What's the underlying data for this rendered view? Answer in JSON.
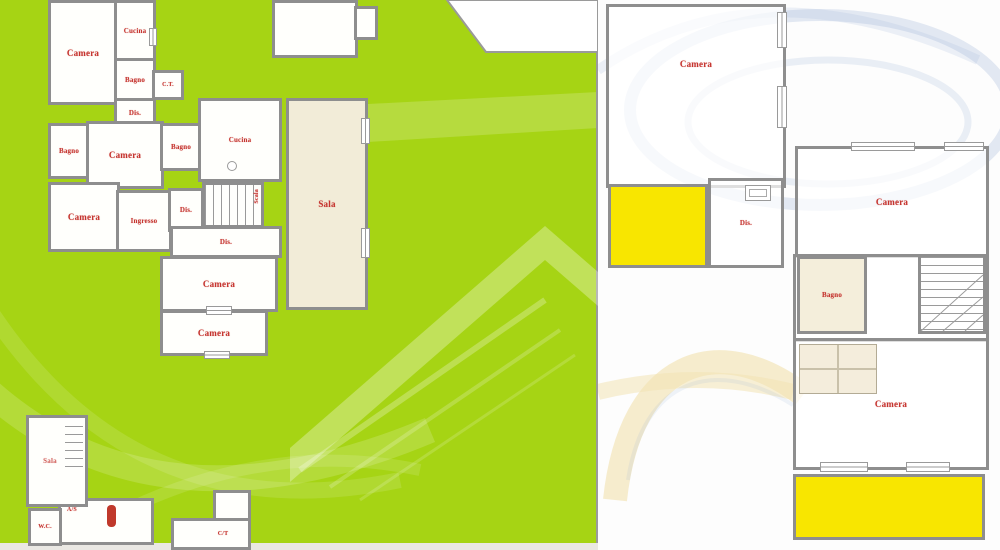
{
  "doc": {
    "type": "real-estate floor plan listing image",
    "floors": 2
  },
  "colors": {
    "ground_bg_green": "#a6d414",
    "highlight_yellow": "#f8e600",
    "room_cream": "#f2ecd8",
    "wall_gray": "#8e8e8e",
    "label_red": "#c5342f",
    "watermark_blue": "#9db4d6"
  },
  "plans": {
    "ground": {
      "name": "Ground floor plan",
      "rooms": {
        "camera_nw": "Camera",
        "cucina_nw": "Cucina",
        "bagno_nw": "Bagno",
        "ct": "C.T.",
        "dis_nw": "Dis.",
        "bagno_w": "Bagno",
        "camera_mid": "Camera",
        "bagno_mid": "Bagno",
        "cucina_mid": "Cucina",
        "dis_mid": "Dis.",
        "ingresso": "Ingresso",
        "camera_w": "Camera",
        "scala": "Scala",
        "dis_low": "Dis.",
        "camera_s1": "Camera",
        "camera_s2": "Camera",
        "sala": "Sala",
        "sala_sw": "Sala",
        "as": "A/S",
        "wc": "W.C.",
        "ct_s": "C/T"
      }
    },
    "first": {
      "name": "First floor plan",
      "rooms": {
        "camera_top": "Camera",
        "dis": "Dis.",
        "camera_e": "Camera",
        "bagno": "Bagno",
        "camera_s": "Camera"
      }
    }
  }
}
